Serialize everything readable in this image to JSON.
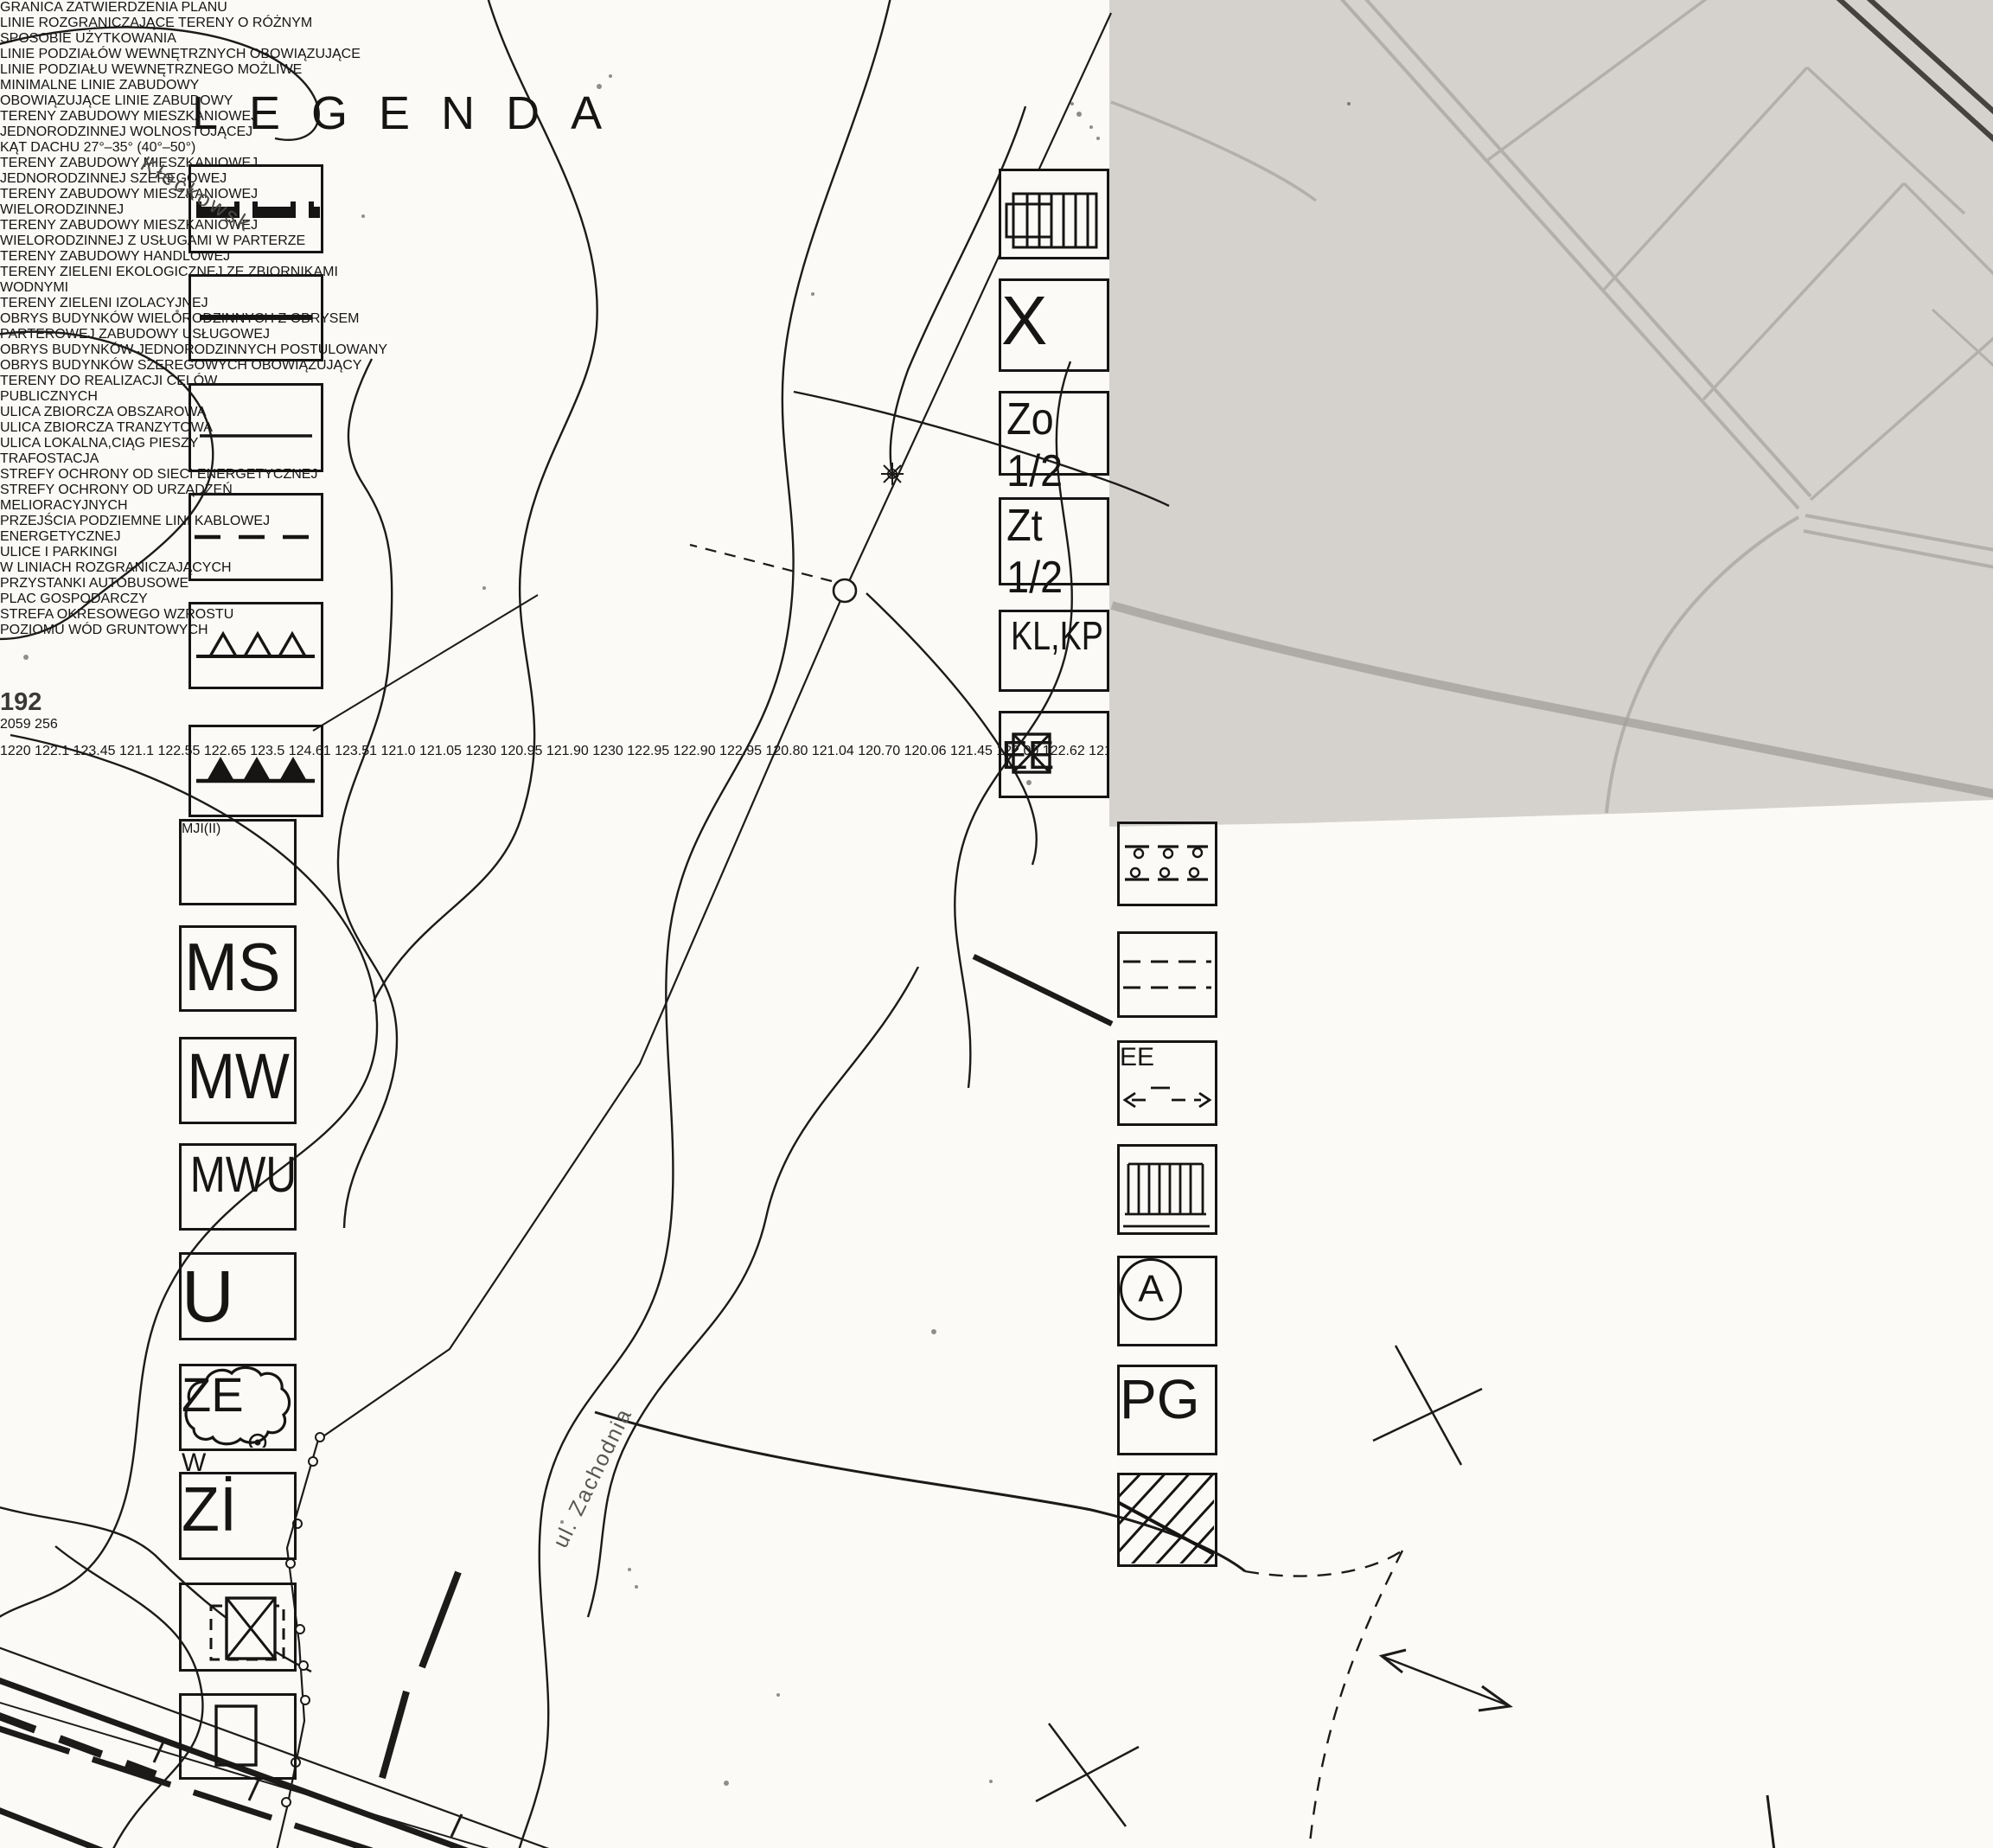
{
  "title": "LEGENDA",
  "legend_left": [
    {
      "label_lines": [
        "GRANICA ZATWIERDZENIA PLANU"
      ]
    },
    {
      "label_lines": [
        "LINIE ROZGRANICZAJĄCE TERENY O RÓŻNYM",
        "SPOSOBIE UŻYTKOWANIA"
      ]
    },
    {
      "label_lines": [
        "LINIE PODZIAŁÓW WEWNĘTRZNYCH OBOWIĄZUJĄCE"
      ]
    },
    {
      "label_lines": [
        "LINIE PODZIAŁU WEWNĘTRZNEGO MOŻLIWE"
      ]
    },
    {
      "label_lines": [
        "MINIMALNE LINIE ZABUDOWY"
      ]
    },
    {
      "label_lines": [
        "OBOWIĄZUJĄCE LINIE ZABUDOWY"
      ]
    },
    {
      "symbol_main": "MJ",
      "symbol_sub_1": "I",
      "symbol_paren_open": "(",
      "symbol_sub_2": "II",
      "symbol_paren_close": ")",
      "label_lines": [
        "TERENY ZABUDOWY MIESZKANIOWEJ",
        "JEDNORODZINNEJ WOLNOSTOJĄCEJ",
        "KĄT DACHU 27°–35°  (40°–50°)"
      ]
    },
    {
      "symbol": "MS",
      "label_lines": [
        "TERENY ZABUDOWY MIESZKANIOWEJ",
        "JEDNORODZINNEJ SZEREGOWEJ"
      ]
    },
    {
      "symbol": "MW",
      "label_lines": [
        "TERENY ZABUDOWY MIESZKANIOWEJ",
        "WIELORODZINNEJ"
      ]
    },
    {
      "symbol": "MWU",
      "label_lines": [
        "TERENY ZABUDOWY MIESZKANIOWEJ",
        "WIELORODZINNEJ Z USŁUGAMI W PARTERZE"
      ]
    },
    {
      "symbol": "U",
      "label_lines": [
        "TERENY ZABUDOWY HANDLOWEJ"
      ]
    },
    {
      "symbol": "ZE",
      "symbol_w": "W",
      "label_lines": [
        "TERENY ZIELENI EKOLOGICZNEJ ZE ZBIORNIKAMI",
        "WODNYMI"
      ]
    },
    {
      "symbol": "Zİ",
      "label_lines": [
        "TERENY ZIELENI IZOLACYJNEJ"
      ]
    },
    {
      "label_lines": [
        "OBRYS BUDYNKÓW WIELORODZINNYCH Z OBRYSEM",
        "PARTEROWEJ ZABUDOWY USŁUGOWEJ"
      ]
    },
    {
      "label_lines": [
        "OBRYS BUDYNKÓW JEDNORODZINNYCH POSTULOWANY"
      ]
    }
  ],
  "legend_right": [
    {
      "label_lines": [
        "OBRYS BUDYNKÓW SZEREGOWYCH OBOWIĄZUJĄCY"
      ]
    },
    {
      "symbol": "X",
      "label_lines": [
        "TERENY DO REALIZACJI CELÓW",
        "PUBLICZNYCH"
      ]
    },
    {
      "symbol": "Zo 1/2",
      "label_lines": [
        "ULICA ZBIORCZA OBSZAROWA"
      ]
    },
    {
      "symbol": "Zt 1/2",
      "label_lines": [
        "ULICA ZBIORCZA TRANZYTOWA"
      ]
    },
    {
      "symbol": "KL,KP",
      "label_lines": [
        "ULICA LOKALNA,CIĄG PIESZY"
      ]
    },
    {
      "symbol": "EE",
      "label_lines": [
        "TRAFOSTACJA"
      ]
    },
    {
      "label_lines": [
        "STREFY OCHRONY OD SIECI ENERGETYCZNEJ"
      ]
    },
    {
      "label_lines": [
        "STREFY OCHRONY OD URZĄDZEŃ",
        "MELIORACYJNYCH"
      ]
    },
    {
      "symbol": "EE",
      "label_lines": [
        "PRZEJŚCIA PODZIEMNE LINI KABLOWEJ",
        "ENERGETYCZNEJ"
      ]
    },
    {
      "label_lines": [
        "ULICE I PARKINGI",
        "W LINIACH ROZGRANICZAJĄCYCH"
      ]
    },
    {
      "symbol": "A",
      "label_lines": [
        "PRZYSTANKI AUTOBUSOWE"
      ]
    },
    {
      "symbol": "PG",
      "label_lines": [
        "PLAC GOSPODARCZY"
      ]
    },
    {
      "label_lines": [
        "STREFA OKRESOWEGO WZROSTU",
        "POZIOMU WÓD GRUNTOWYCH"
      ]
    }
  ],
  "map": {
    "street_1": "ul. Zachodnia",
    "street_2": "Kłeckowsk",
    "parcel_number": "192"
  },
  "survey_fraction": {
    "top": "2059",
    "bottom": "256"
  },
  "annotations": [
    {
      "text": "1220"
    },
    {
      "text": "122.1"
    },
    {
      "text": "123.45"
    },
    {
      "text": "121.1"
    },
    {
      "text": "122.55"
    },
    {
      "text": "122.65"
    },
    {
      "text": "123.5"
    },
    {
      "text": "124.61"
    },
    {
      "text": "123.51"
    },
    {
      "text": "121.0"
    },
    {
      "text": "121.05"
    },
    {
      "text": "1230"
    },
    {
      "text": "120.95"
    },
    {
      "text": "121.90"
    },
    {
      "text": "1230"
    },
    {
      "text": "122.95"
    },
    {
      "text": "122.90"
    },
    {
      "text": "122.95"
    },
    {
      "text": "120.80"
    },
    {
      "text": "121.04"
    },
    {
      "text": "120.70"
    },
    {
      "text": "120.06"
    },
    {
      "text": "121.45"
    },
    {
      "text": "122.00"
    },
    {
      "text": "122.62"
    },
    {
      "text": "121.42"
    },
    {
      "text": "121.62"
    },
    {
      "text": "121.52"
    },
    {
      "text": "m B300"
    },
    {
      "text": "61"
    },
    {
      "text": "121.10"
    },
    {
      "text": "wB160"
    },
    {
      "text": "91"
    },
    {
      "text": "125.05"
    }
  ],
  "colors": {
    "ink": "#161514",
    "paper": "#fbfaf7",
    "map_gray": "#d8d5d1",
    "street_gray": "#b3b0ac",
    "dark_road": "#45423f"
  }
}
